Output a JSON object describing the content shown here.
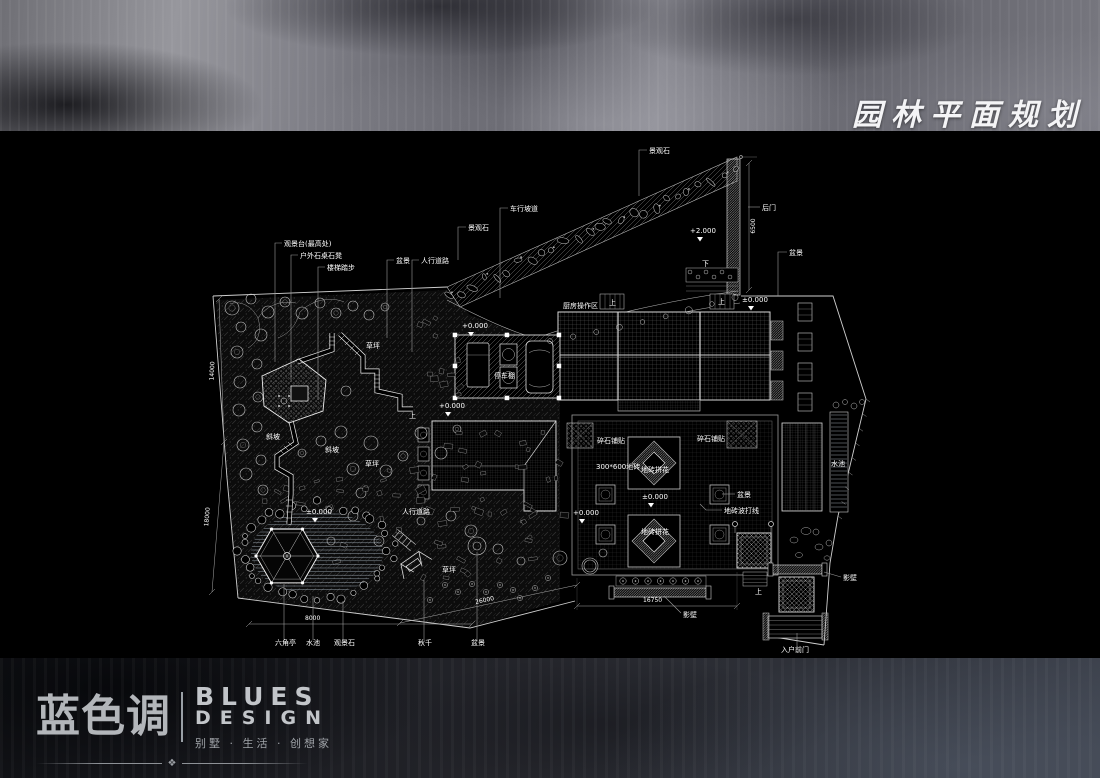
{
  "header": {
    "title": "园林平面规划"
  },
  "footer": {
    "logo_cn": "蓝色调",
    "logo_en_line1": "BLUES",
    "logo_en_line2": "DESIGN",
    "tagline": "别墅 · 生活 · 创想家",
    "ornament": "❖"
  },
  "colors": {
    "background": "#000000",
    "line": "#d9d9d9",
    "label": "#ffffff"
  },
  "plan": {
    "annotations": [
      {
        "t": "景观石",
        "x": 649,
        "y": 153,
        "lead": [
          [
            647,
            150
          ],
          [
            639,
            150
          ],
          [
            639,
            196
          ]
        ]
      },
      {
        "t": "车行坡道",
        "x": 510,
        "y": 211,
        "lead": [
          [
            508,
            208
          ],
          [
            500,
            208
          ],
          [
            500,
            298
          ]
        ]
      },
      {
        "t": "景观石",
        "x": 468,
        "y": 230,
        "lead": [
          [
            466,
            227
          ],
          [
            458,
            227
          ],
          [
            458,
            260
          ]
        ]
      },
      {
        "t": "后门",
        "x": 762,
        "y": 210,
        "lead": [
          [
            760,
            207
          ],
          [
            748,
            207
          ]
        ]
      },
      {
        "t": "+2.000",
        "x": 690,
        "y": 233,
        "tri": [
          700,
          237
        ]
      },
      {
        "t": "6500",
        "x": 755,
        "y": 226,
        "r": -90,
        "a": "middle",
        "s": 6
      },
      {
        "t": "盆景",
        "x": 789,
        "y": 255,
        "lead": [
          [
            787,
            252
          ],
          [
            778,
            252
          ],
          [
            778,
            296
          ]
        ]
      },
      {
        "t": "观景台(最高处)",
        "x": 284,
        "y": 246,
        "lead": [
          [
            282,
            243
          ],
          [
            275,
            243
          ],
          [
            275,
            362
          ]
        ]
      },
      {
        "t": "户外石桌石凳",
        "x": 300,
        "y": 258,
        "lead": [
          [
            298,
            255
          ],
          [
            291,
            255
          ],
          [
            291,
            380
          ]
        ]
      },
      {
        "t": "楼梯踏步",
        "x": 327,
        "y": 270,
        "lead": [
          [
            325,
            267
          ],
          [
            318,
            267
          ],
          [
            318,
            400
          ]
        ]
      },
      {
        "t": "盆景",
        "x": 396,
        "y": 263,
        "lead": [
          [
            394,
            260
          ],
          [
            387,
            260
          ],
          [
            387,
            338
          ]
        ]
      },
      {
        "t": "人行道路",
        "x": 421,
        "y": 263,
        "lead": [
          [
            419,
            260
          ],
          [
            412,
            260
          ],
          [
            412,
            352
          ]
        ]
      },
      {
        "t": "厨房操作区",
        "x": 563,
        "y": 308
      },
      {
        "t": "上",
        "x": 609,
        "y": 305
      },
      {
        "t": "上",
        "x": 718,
        "y": 304
      },
      {
        "t": "下",
        "x": 702,
        "y": 266
      },
      {
        "t": "±0.000",
        "x": 742,
        "y": 302,
        "tri": [
          751,
          306
        ]
      },
      {
        "t": "停车棚",
        "x": 494,
        "y": 378
      },
      {
        "t": "+0.000",
        "x": 462,
        "y": 328,
        "tri": [
          471,
          332
        ]
      },
      {
        "t": "+0.000",
        "x": 439,
        "y": 408,
        "tri": [
          448,
          412
        ]
      },
      {
        "t": "碎石铺贴",
        "x": 597,
        "y": 443
      },
      {
        "t": "碎石铺贴",
        "x": 697,
        "y": 441
      },
      {
        "t": "300*600地砖",
        "x": 596,
        "y": 469
      },
      {
        "t": "地砖拼花",
        "x": 641,
        "y": 472
      },
      {
        "t": "±0.000",
        "x": 642,
        "y": 499,
        "tri": [
          651,
          503
        ]
      },
      {
        "t": "+0.000",
        "x": 573,
        "y": 515,
        "tri": [
          582,
          519
        ]
      },
      {
        "t": "地砖拼花",
        "x": 641,
        "y": 534
      },
      {
        "t": "盆景",
        "x": 737,
        "y": 497,
        "lead": [
          [
            735,
            494
          ],
          [
            722,
            494
          ]
        ]
      },
      {
        "t": "地砖波打线",
        "x": 724,
        "y": 513,
        "lead": [
          [
            722,
            510
          ],
          [
            706,
            510
          ],
          [
            700,
            504
          ]
        ]
      },
      {
        "t": "水池",
        "x": 831,
        "y": 466
      },
      {
        "t": "草坪",
        "x": 366,
        "y": 348
      },
      {
        "t": "草坪",
        "x": 365,
        "y": 466
      },
      {
        "t": "草坪",
        "x": 442,
        "y": 572
      },
      {
        "t": "斜坡",
        "x": 266,
        "y": 439
      },
      {
        "t": "斜坡",
        "x": 325,
        "y": 452
      },
      {
        "t": "±0.000",
        "x": 306,
        "y": 514,
        "tri": [
          315,
          518
        ]
      },
      {
        "t": "人行道路",
        "x": 402,
        "y": 514
      },
      {
        "t": "上",
        "x": 409,
        "y": 418
      },
      {
        "t": "六角亭",
        "x": 275,
        "y": 645,
        "lead": [
          [
            284,
            640
          ],
          [
            284,
            584
          ]
        ]
      },
      {
        "t": "水池",
        "x": 306,
        "y": 645,
        "lead": [
          [
            313,
            640
          ],
          [
            313,
            596
          ]
        ]
      },
      {
        "t": "观景石",
        "x": 334,
        "y": 645,
        "lead": [
          [
            343,
            640
          ],
          [
            343,
            601
          ]
        ]
      },
      {
        "t": "秋千",
        "x": 418,
        "y": 645,
        "lead": [
          [
            424,
            640
          ],
          [
            424,
            580
          ]
        ]
      },
      {
        "t": "盆景",
        "x": 471,
        "y": 645,
        "lead": [
          [
            477,
            640
          ],
          [
            477,
            552
          ]
        ]
      },
      {
        "t": "8000",
        "x": 305,
        "y": 620,
        "s": 6
      },
      {
        "t": "26000",
        "x": 485,
        "y": 602,
        "r": -12,
        "a": "middle",
        "s": 6
      },
      {
        "t": "16750",
        "x": 643,
        "y": 602,
        "s": 6
      },
      {
        "t": "14000",
        "x": 214,
        "y": 371,
        "r": -88,
        "a": "middle",
        "s": 6
      },
      {
        "t": "18000",
        "x": 209,
        "y": 517,
        "r": -85,
        "a": "middle",
        "s": 6
      },
      {
        "t": "影壁",
        "x": 683,
        "y": 617,
        "lead": [
          [
            681,
            613
          ],
          [
            664,
            596
          ]
        ]
      },
      {
        "t": "影壁",
        "x": 843,
        "y": 580,
        "lead": [
          [
            841,
            577
          ],
          [
            824,
            572
          ]
        ]
      },
      {
        "t": "上",
        "x": 755,
        "y": 594
      },
      {
        "t": "入户前门",
        "x": 781,
        "y": 652,
        "lead": [
          [
            797,
            646
          ],
          [
            797,
            633
          ]
        ]
      }
    ]
  }
}
